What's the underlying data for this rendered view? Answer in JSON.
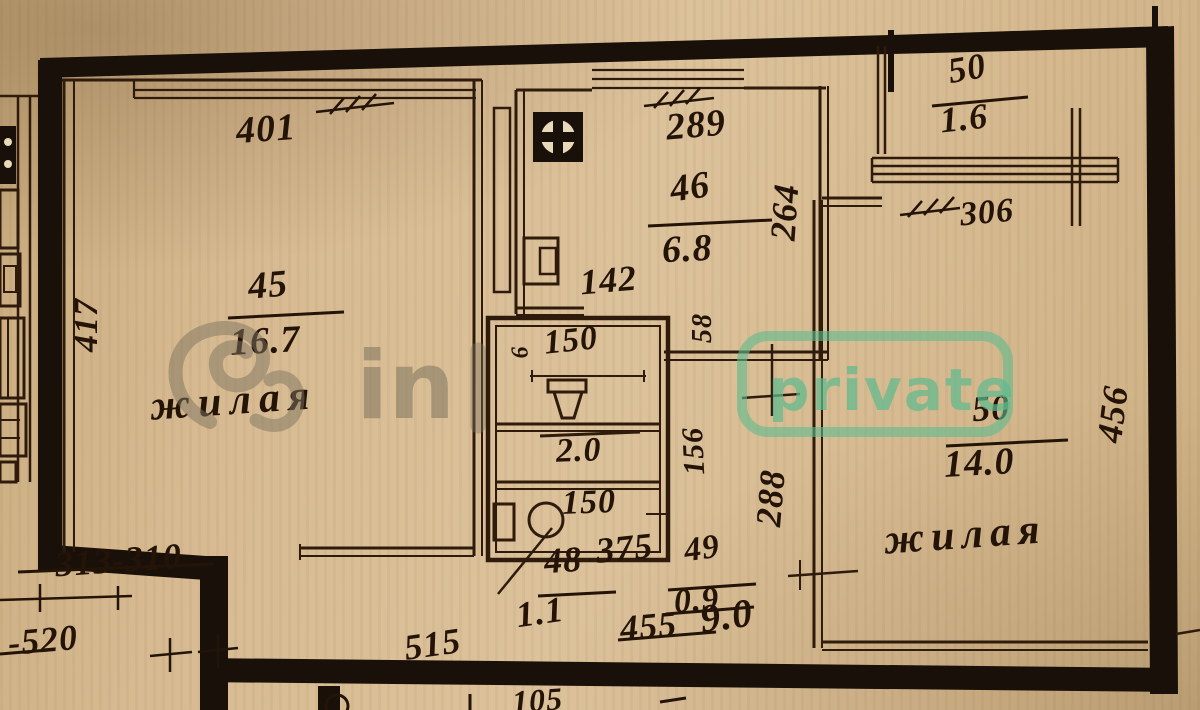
{
  "document": {
    "kind": "scanned apartment floor plan",
    "language": "ru"
  },
  "rooms": {
    "living_45": {
      "number": "45",
      "area": "16.7",
      "name": "жилая"
    },
    "kitchen_46": {
      "number": "46",
      "area": "6.8"
    },
    "bath_mid": {
      "area": "2.0"
    },
    "hall_48": {
      "number": "48",
      "area": "1.1"
    },
    "storage_49": {
      "number": "49",
      "area": "0.9"
    },
    "living_50": {
      "number": "50",
      "area": "14.0",
      "name": "жилая"
    },
    "balcony_50": {
      "number": "50",
      "area": "1.6"
    }
  },
  "dimensions": {
    "room45_top": "401",
    "room45_left": "417",
    "kitchen_top": "289",
    "kitchen_right": "264",
    "kitchen_inner": "142",
    "duct": "58",
    "wc_width": "150",
    "wc_side": "6",
    "bath_width": "150",
    "mid_right": "156",
    "hall_right": "288",
    "balcony_width": "306",
    "room50_right": "456",
    "hall_top": "375",
    "hall_bottom_struck": "455",
    "hall_bottom": "9.0",
    "hall_width": "515",
    "bottom_left_pair": "313-310",
    "bottom_left": "-520",
    "edge_partial": "105"
  },
  "watermark": {
    "prefix": "in",
    "badge": "private",
    "green_color": "#5eba8e",
    "grey_color": "#8a7f6d"
  },
  "ink": {
    "wall_color": "#191009",
    "line_color": "#2e1b0c",
    "text_color": "#241408"
  }
}
